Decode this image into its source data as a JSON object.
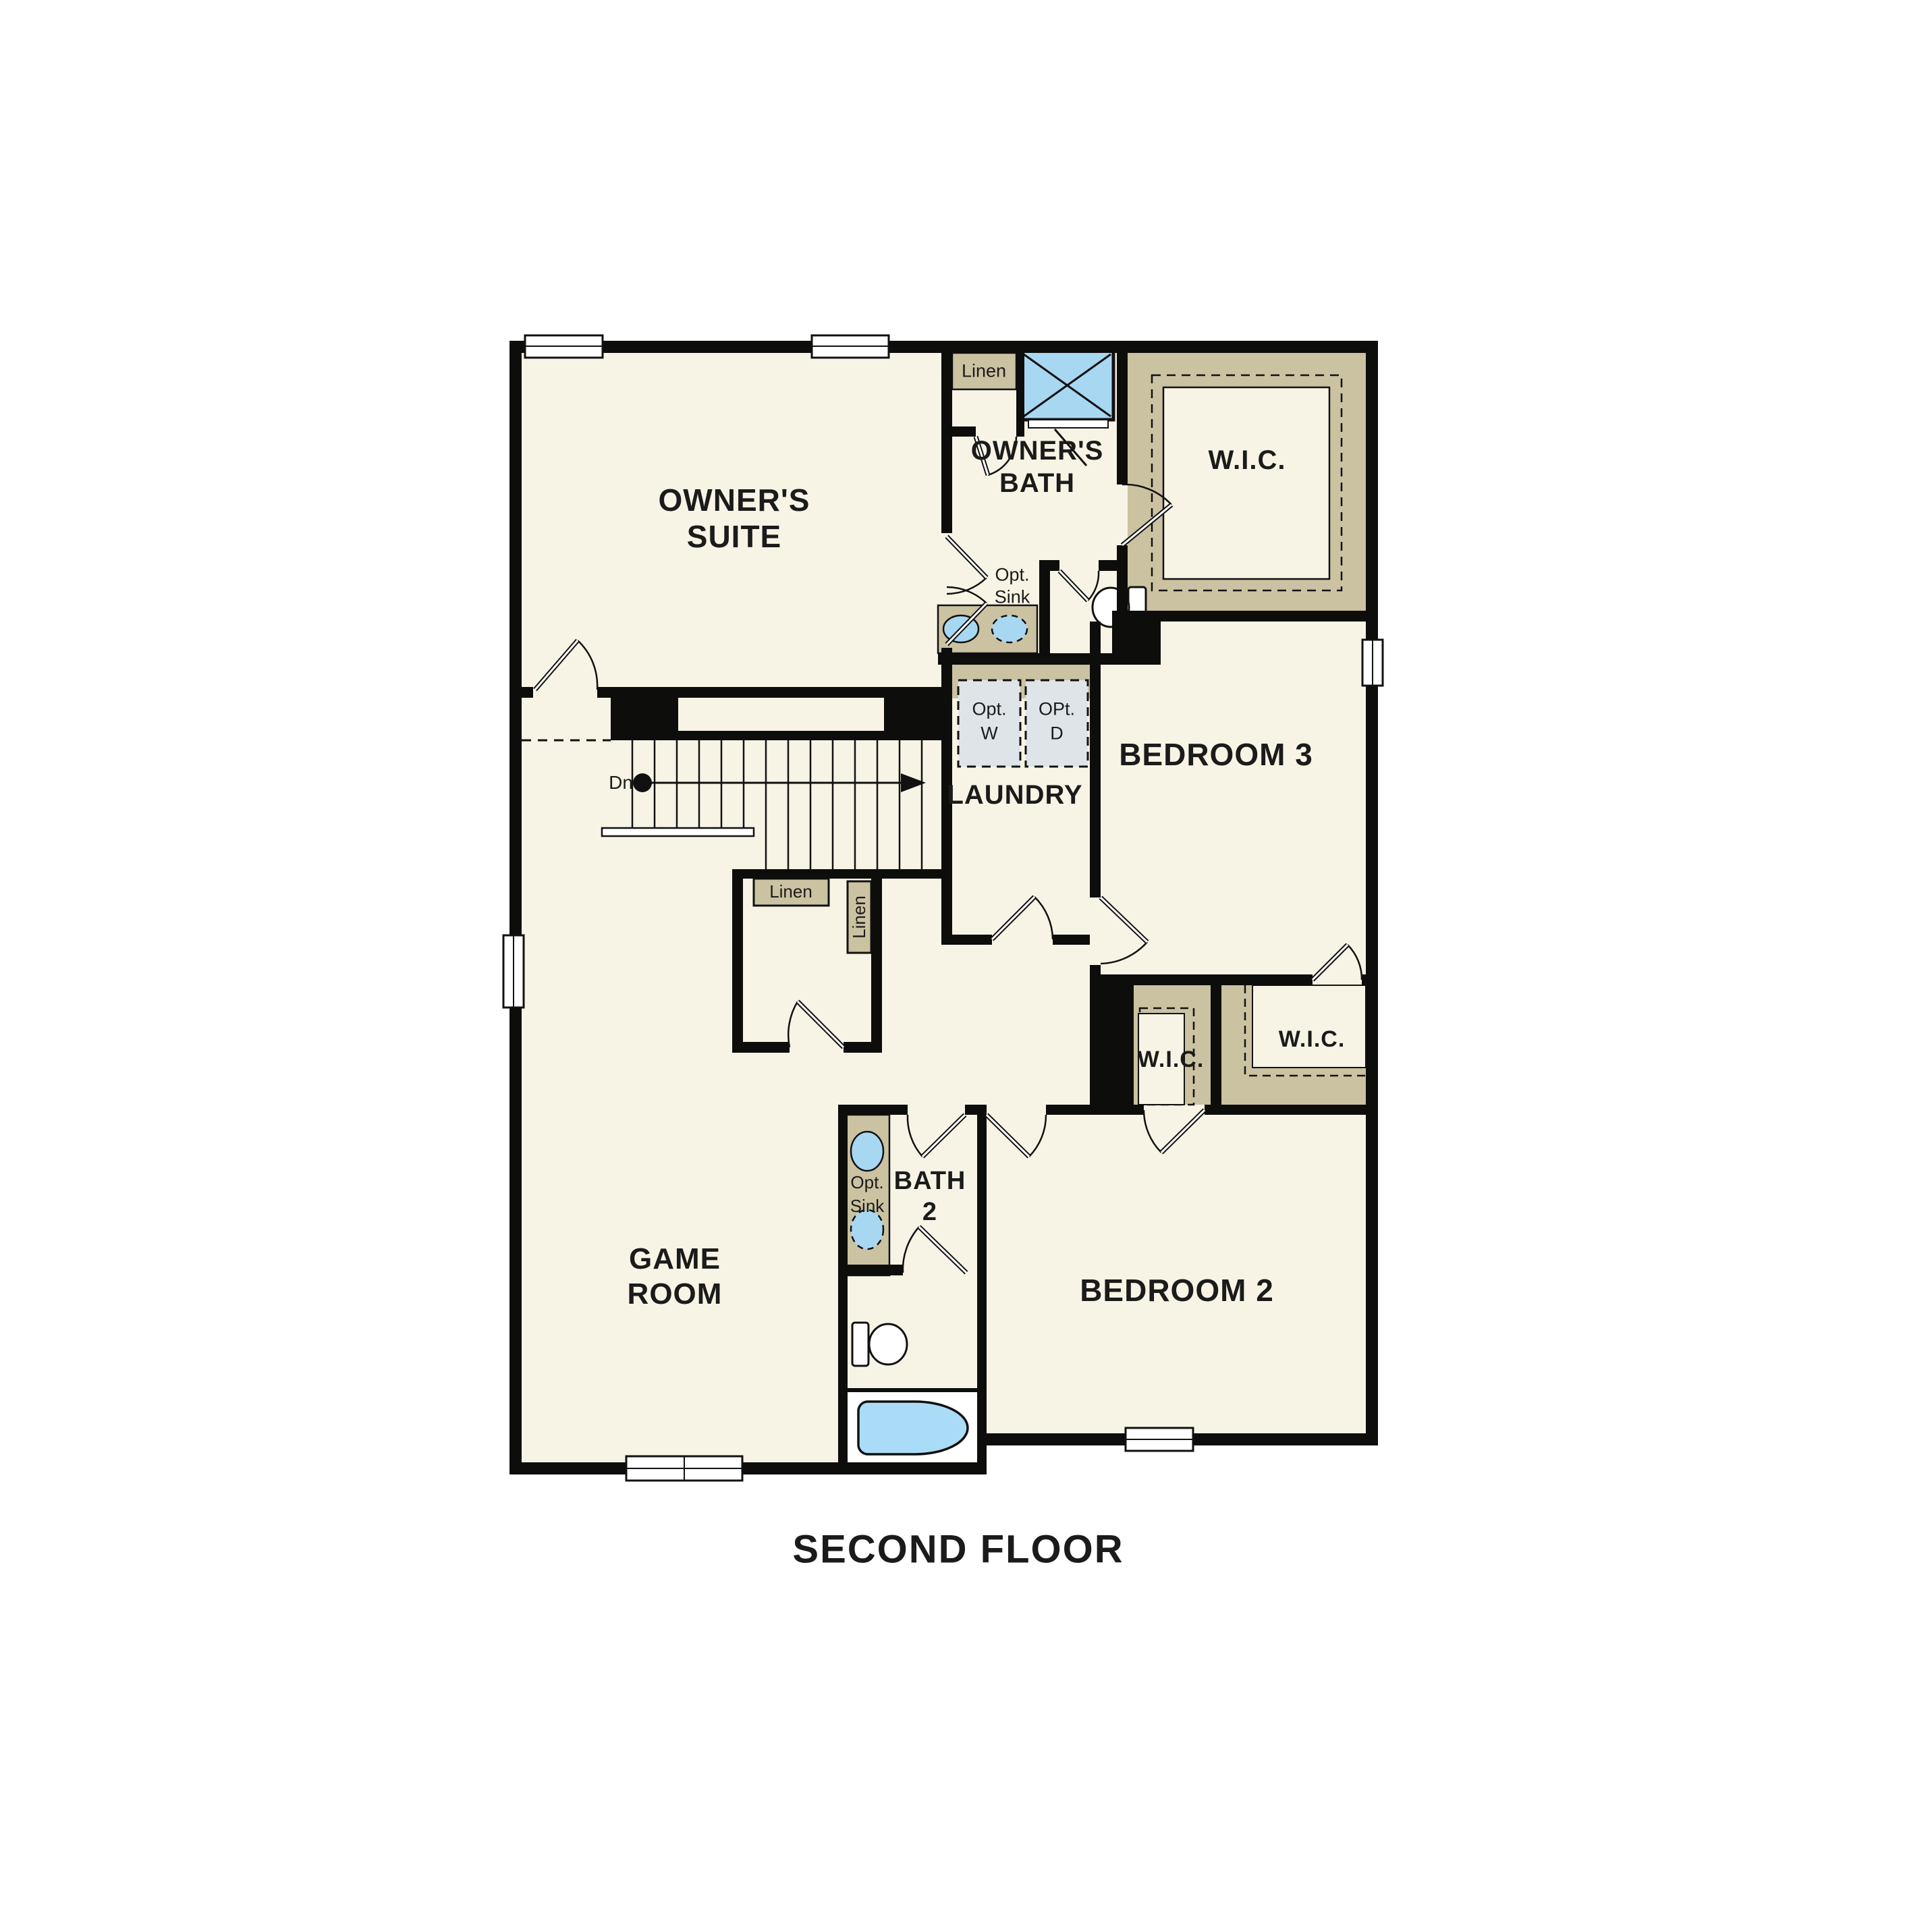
{
  "title": "SECOND FLOOR",
  "colors": {
    "floor": "#f8f4e5",
    "shelving_tan": "#cbc2a2",
    "fixture_blue": "#a8d7f2",
    "tub_blue": "#abdcf7",
    "appliance_gray": "#dee4e8",
    "wall_black": "#0d0d0b",
    "window_white": "#ffffff"
  },
  "rooms": {
    "owners_suite": {
      "line1": "OWNER'S",
      "line2": "SUITE"
    },
    "owners_bath": {
      "line1": "OWNER'S",
      "line2": "BATH"
    },
    "wic_master": {
      "label": "W.I.C."
    },
    "laundry": {
      "label": "LAUNDRY"
    },
    "bedroom3": {
      "label": "BEDROOM 3"
    },
    "wic_left": {
      "label": "W.I.C."
    },
    "wic_right": {
      "label": "W.I.C."
    },
    "game_room": {
      "line1": "GAME",
      "line2": "ROOM"
    },
    "bath2": {
      "line1": "BATH",
      "line2": "2"
    },
    "bedroom2": {
      "label": "BEDROOM 2"
    }
  },
  "closets": {
    "linen_top": "Linen",
    "linen_hall": "Linen",
    "linen_vertical": "Linen"
  },
  "fixtures": {
    "owners_bath_opt_sink": {
      "line1": "Opt.",
      "line2": "Sink"
    },
    "bath2_opt_sink": {
      "line1": "Opt.",
      "line2": "Sink"
    },
    "washer": {
      "line1": "Opt.",
      "line2": "W"
    },
    "dryer": {
      "line1": "OPt.",
      "line2": "D"
    },
    "stairs_down": "Dn"
  }
}
